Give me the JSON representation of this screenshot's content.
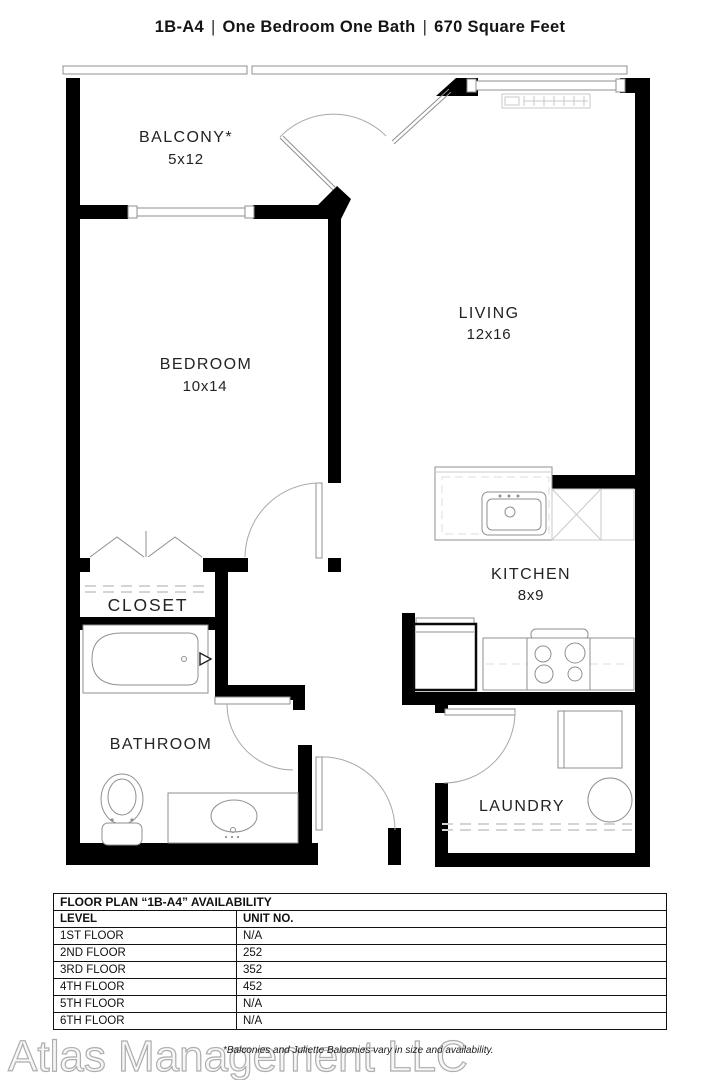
{
  "title": {
    "unit": "1B-A4",
    "separator": "|",
    "bed_bath": "One Bedroom One Bath",
    "area": "670 Square Feet"
  },
  "rooms": {
    "balcony": {
      "label": "BALCONY*",
      "dims": "5x12"
    },
    "bedroom": {
      "label": "BEDROOM",
      "dims": "10x14"
    },
    "living": {
      "label": "LIVING",
      "dims": "12x16"
    },
    "closet": {
      "label": "CLOSET"
    },
    "kitchen": {
      "label": "KITCHEN",
      "dims": "8x9"
    },
    "bathroom": {
      "label": "BATHROOM"
    },
    "laundry": {
      "label": "LAUNDRY"
    }
  },
  "availability_table": {
    "title": "FLOOR PLAN “1B-A4” AVAILABILITY",
    "columns": [
      "LEVEL",
      "UNIT NO."
    ],
    "rows": [
      {
        "level": "1ST FLOOR",
        "unit": "N/A"
      },
      {
        "level": "2ND FLOOR",
        "unit": "252"
      },
      {
        "level": "3RD FLOOR",
        "unit": "352"
      },
      {
        "level": "4TH FLOOR",
        "unit": "452"
      },
      {
        "level": "5TH FLOOR",
        "unit": "N/A"
      },
      {
        "level": "6TH FLOOR",
        "unit": "N/A"
      }
    ]
  },
  "footer": {
    "watermark": "Atlas Management LLC",
    "disclaimer": "*Balconies and Juliette Balconies vary in size and availability."
  },
  "colors": {
    "wall": "#000000",
    "fixture_line": "#999999",
    "label_text": "#222222"
  }
}
